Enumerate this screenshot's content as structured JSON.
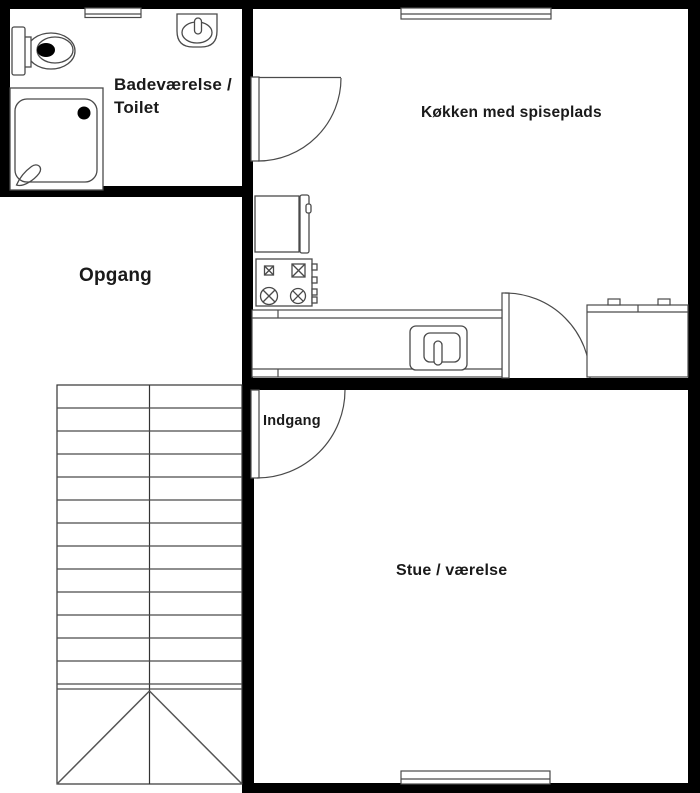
{
  "plan": {
    "type": "apartment-floor-plan",
    "rooms": {
      "bathroom": {
        "label": "Badeværelse / Toilet"
      },
      "stairwell": {
        "label": "Opgang"
      },
      "kitchen": {
        "label": "Køkken med spiseplads"
      },
      "entrance": {
        "label": "Indgang"
      },
      "living_room": {
        "label": "Stue / værelse"
      }
    },
    "fixtures": {
      "bathroom": [
        "toilet",
        "washbasin",
        "shower"
      ],
      "kitchen": [
        "refrigerator",
        "stove",
        "counter-with-sink",
        "counter"
      ],
      "stairwell": [
        "staircase-with-direction-arrow"
      ],
      "doors": [
        "kitchen-door",
        "kitchen-rear-door",
        "entrance-door"
      ],
      "windows": [
        "bathroom-window",
        "kitchen-window",
        "living-room-window"
      ]
    },
    "colors": {
      "wall": "#000000",
      "fixture_line": "#4a4a4a",
      "text": "#1a1a1a",
      "background": "#ffffff"
    }
  }
}
